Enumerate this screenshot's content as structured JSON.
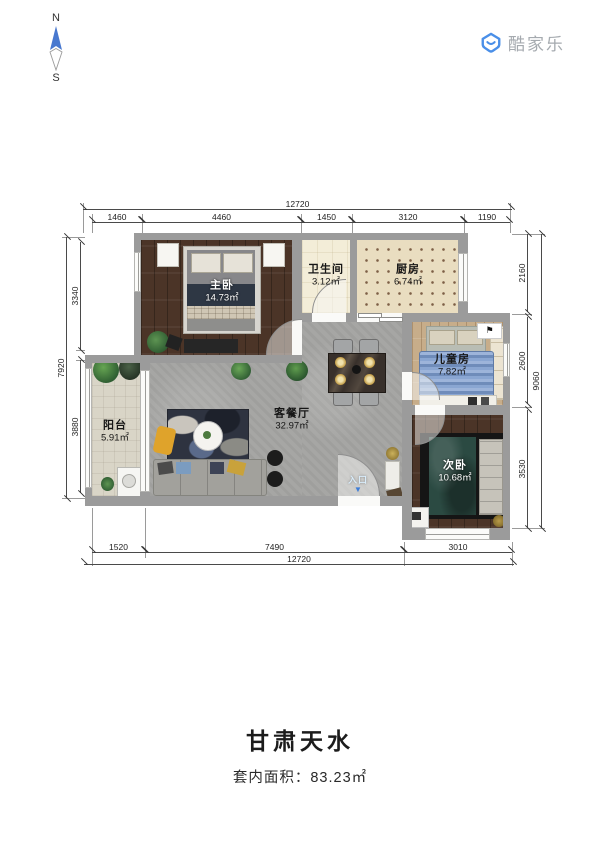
{
  "compass": {
    "north": "N",
    "south": "S"
  },
  "brand": {
    "name": "酷家乐"
  },
  "colors": {
    "accent_blue": "#4a8fe8",
    "compass_blue": "#4878cf",
    "entry_arrow": "#3d7dd8"
  },
  "plan": {
    "rooms": {
      "master": {
        "label": "主卧",
        "area": "14.73㎡"
      },
      "bath": {
        "label": "卫生间",
        "area": "3.12㎡"
      },
      "kitchen": {
        "label": "厨房",
        "area": "6.74㎡"
      },
      "kids": {
        "label": "儿童房",
        "area": "7.82㎡"
      },
      "second": {
        "label": "次卧",
        "area": "10.68㎡"
      },
      "living": {
        "label": "客餐厅",
        "area": "32.97㎡"
      },
      "balcony": {
        "label": "阳台",
        "area": "5.91㎡"
      }
    },
    "entrance": {
      "label": "入口",
      "arrow": "▼"
    },
    "dimensions": {
      "top_total": "12720",
      "top_segments": [
        "1460",
        "4460",
        "1450",
        "3120",
        "1190"
      ],
      "bottom_segments": [
        "1520",
        "7490",
        "3010"
      ],
      "bottom_total": "12720",
      "left_total": "7920",
      "left_segments": [
        "3340",
        "3880"
      ],
      "right_segments": [
        "2160",
        "2600",
        "3530"
      ],
      "right_total": "9060"
    }
  },
  "footer": {
    "title": "甘肃天水",
    "area_label": "套内面积：83.23㎡"
  }
}
